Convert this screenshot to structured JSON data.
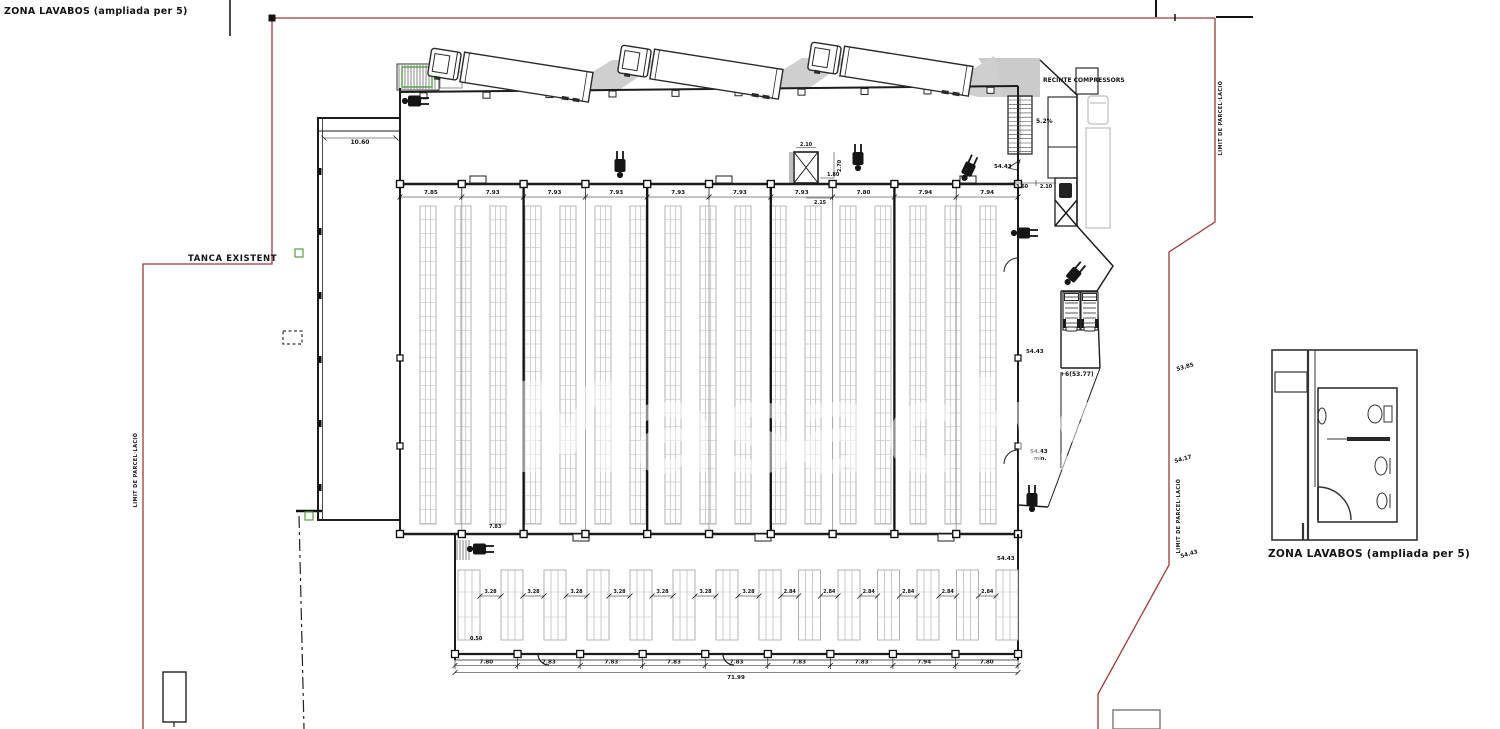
{
  "plan": {
    "captions": {
      "top_left": "ZONA LAVABOS (ampliada per 5)",
      "detail": "ZONA LAVABOS (ampliada per 5)"
    },
    "labels": {
      "tanca_existent": "TANCA EXISTENT",
      "recinte_compressors": "RECINTE COMPRESSORS",
      "ramp_slope": "5.2%",
      "wing_width": "10.60",
      "limit_parcellacio_left": "LIMIT DE PARCEL·LACIÓ",
      "limit_parcellacio_right_top": "LIMIT DE PARCEL·LACIÓ",
      "limit_parcellacio_right_bottom": "LIMIT DE PARCEL·LACIÓ",
      "interior_bay": "7.83",
      "annex_offset": "0.50",
      "dock_level": "+6(53.77)",
      "entry_dim_a": "3.60",
      "entry_dim_b": "2.10",
      "stair_w": "2.10",
      "stair_d1": "1.80",
      "stair_d2": "2.70",
      "stair_d3": "2.15",
      "min_note": "min."
    },
    "dimensions": {
      "top_bays": [
        "7.85",
        "7.93",
        "7.93",
        "7.93",
        "7.93",
        "7.93",
        "7.93",
        "7.80",
        "7.94",
        "7.94"
      ],
      "bottom_bays": [
        "7.80",
        "7.83",
        "7.83",
        "7.83",
        "7.83",
        "7.83",
        "7.83",
        "7.94",
        "7.80"
      ],
      "bottom_total": "71.99",
      "annex_gaps": [
        "3.28",
        "3.28",
        "3.28",
        "3.28",
        "3.28",
        "3.28",
        "3.28",
        "2.84",
        "2.84",
        "2.84",
        "2.84",
        "2.84",
        "2.84"
      ]
    },
    "spot_elevations": [
      {
        "label": "54.43",
        "x": 994,
        "y": 168,
        "rot": 0
      },
      {
        "label": "54.43",
        "x": 1026,
        "y": 353,
        "rot": 0
      },
      {
        "label": "54.43",
        "x": 1030,
        "y": 453,
        "rot": 0
      },
      {
        "label": "54.43",
        "x": 997,
        "y": 560,
        "rot": 0
      },
      {
        "label": "53.85",
        "x": 1177,
        "y": 371,
        "rot": -16
      },
      {
        "label": "54.17",
        "x": 1175,
        "y": 463,
        "rot": -16
      },
      {
        "label": "54.43",
        "x": 1181,
        "y": 558,
        "rot": -16
      }
    ],
    "watermark": "Masachs",
    "colors": {
      "line": "#1c1c1c",
      "boundary_red": "#9c3b38",
      "rack_gray": "#ababab",
      "shade_gray": "#cbcbcb",
      "accent_green": "#55a046",
      "ghost_gray": "#bdbdbd"
    }
  }
}
